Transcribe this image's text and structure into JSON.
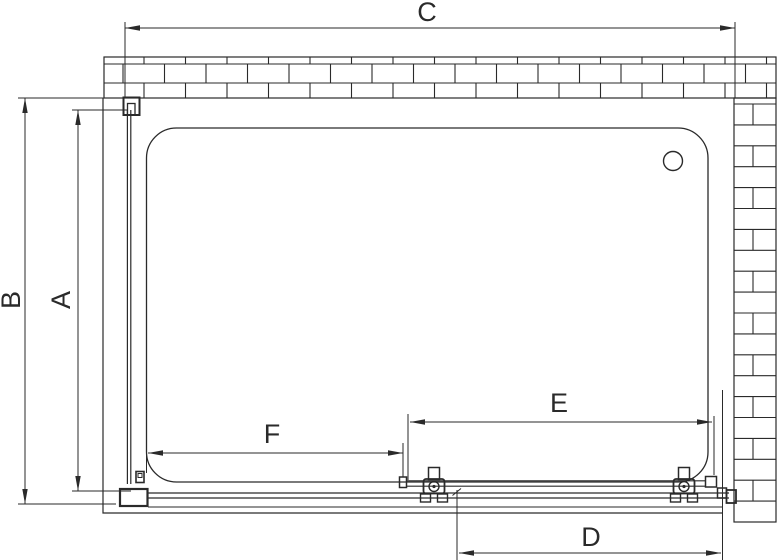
{
  "drawing": {
    "line_color": "#2a2a2a",
    "labels": {
      "A": "A",
      "B": "B",
      "C": "C",
      "D": "D",
      "E": "E",
      "F": "F"
    },
    "dimensions": [
      {
        "id": "C",
        "label": "C",
        "orient": "h",
        "y": 28,
        "x1": 125,
        "x2": 735,
        "label_x": 427,
        "label_y": 14,
        "rotated": false
      },
      {
        "id": "B",
        "label": "B",
        "orient": "v",
        "x": 25,
        "y1": 98,
        "y2": 504,
        "label_x": 13,
        "label_y": 300,
        "rotated": true
      },
      {
        "id": "A",
        "label": "A",
        "orient": "v",
        "x": 78,
        "y1": 110,
        "y2": 491,
        "label_x": 63,
        "label_y": 300,
        "rotated": true
      },
      {
        "id": "F",
        "label": "F",
        "orient": "h",
        "y": 453,
        "x1": 148,
        "x2": 403,
        "label_x": 272,
        "label_y": 436,
        "rotated": false
      },
      {
        "id": "E",
        "label": "E",
        "orient": "h",
        "y": 422,
        "x1": 410,
        "x2": 712,
        "label_x": 559,
        "label_y": 405,
        "rotated": false
      },
      {
        "id": "D",
        "label": "D",
        "orient": "h",
        "y": 553,
        "x1": 459,
        "x2": 721,
        "label_x": 591,
        "label_y": 539,
        "rotated": false
      }
    ],
    "extension_lines": [
      {
        "x1": 125,
        "y1": 22,
        "x2": 125,
        "y2": 98
      },
      {
        "x1": 735,
        "y1": 22,
        "x2": 735,
        "y2": 98
      },
      {
        "x1": 18,
        "y1": 98,
        "x2": 104,
        "y2": 98
      },
      {
        "x1": 18,
        "y1": 504,
        "x2": 116,
        "y2": 504
      },
      {
        "x1": 72,
        "y1": 110,
        "x2": 128,
        "y2": 110
      },
      {
        "x1": 72,
        "y1": 491,
        "x2": 131,
        "y2": 491
      },
      {
        "x1": 146.5,
        "y1": 446,
        "x2": 146.5,
        "y2": 473
      },
      {
        "x1": 403,
        "y1": 443,
        "x2": 403,
        "y2": 477
      },
      {
        "x1": 408,
        "y1": 414,
        "x2": 408,
        "y2": 480
      },
      {
        "x1": 714,
        "y1": 416,
        "x2": 714,
        "y2": 475
      },
      {
        "x1": 722.5,
        "y1": 390,
        "x2": 722.5,
        "y2": 560
      },
      {
        "x1": 457,
        "y1": 490,
        "x2": 457,
        "y2": 560
      }
    ],
    "back_wall": {
      "x": 104,
      "y": 57,
      "w": 672,
      "h": 41,
      "row_lines": [
        64,
        83
      ],
      "rows": [
        {
          "y0": 57,
          "y1": 64,
          "start": 144,
          "step": 41.5
        },
        {
          "y0": 64,
          "y1": 83,
          "start": 123,
          "step": 41.5
        },
        {
          "y0": 83,
          "y1": 98,
          "start": 144,
          "step": 41.5
        }
      ]
    },
    "side_wall": {
      "x": 734,
      "y": 98,
      "w": 42,
      "y_end": 522,
      "row_start": 104,
      "row_step": 20.9,
      "joint_x": 753
    },
    "tray": {
      "x": 146.5,
      "y": 128,
      "w": 561.5,
      "h": 354,
      "radius": 30
    },
    "drain": {
      "cx": 673,
      "cy": 161,
      "r": 9.5
    },
    "roller_centers": [
      434,
      684
    ]
  }
}
